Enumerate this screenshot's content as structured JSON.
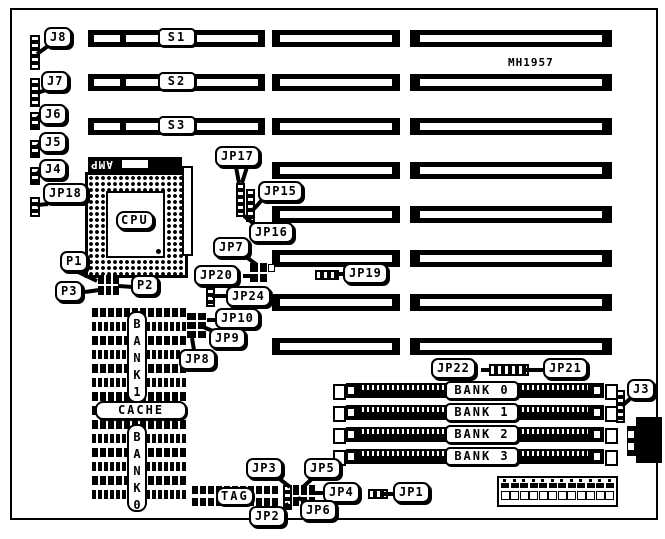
{
  "board": {
    "part_number": "MH1957"
  },
  "cpu": {
    "label": "CPU",
    "socket_brand": "AMP"
  },
  "slots": {
    "labels": [
      "S1",
      "S2",
      "S3"
    ]
  },
  "memory": {
    "simm_banks": [
      "BANK 0",
      "BANK 1",
      "BANK 2",
      "BANK 3"
    ],
    "bank1_vertical": "BANK1",
    "bank0_vertical": "BANK0",
    "cache_label": "CACHE",
    "tag_label": "TAG"
  },
  "connectors": {
    "j3": "J3",
    "j4": "J4",
    "j5": "J5",
    "j6": "J6",
    "j7": "J7",
    "j8": "J8"
  },
  "ports": {
    "p1": "P1",
    "p2": "P2",
    "p3": "P3"
  },
  "jumpers": {
    "jp1": "JP1",
    "jp2": "JP2",
    "jp3": "JP3",
    "jp4": "JP4",
    "jp5": "JP5",
    "jp6": "JP6",
    "jp7": "JP7",
    "jp8": "JP8",
    "jp9": "JP9",
    "jp10": "JP10",
    "jp15": "JP15",
    "jp16": "JP16",
    "jp17": "JP17",
    "jp18": "JP18",
    "jp19": "JP19",
    "jp20": "JP20",
    "jp21": "JP21",
    "jp22": "JP22",
    "jp24": "JP24"
  }
}
